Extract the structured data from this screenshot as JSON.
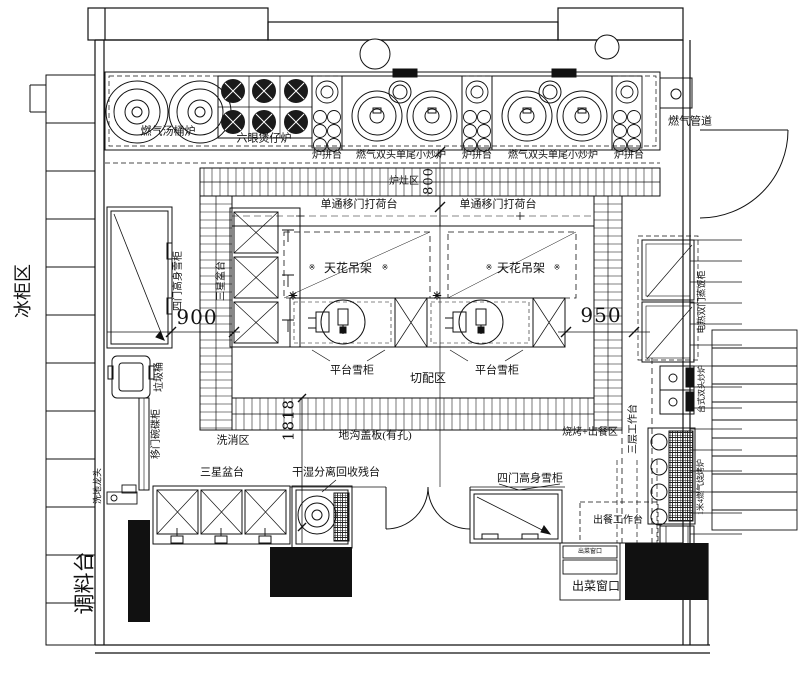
{
  "colors": {
    "ink": "#111111",
    "background": "#ffffff"
  },
  "labels": {
    "soup_stove": "燃气汤桶炉",
    "six_eye_stove": "六眼煲仔炉",
    "stove_side_table": "炉拼台",
    "wok_stove": "燃气双头单尾小炒炉",
    "gas_pipe": "燃气管道",
    "stove_zone": "炉灶区",
    "pass_counter": "单通移门打荷台",
    "ceiling_rack": "天花吊架",
    "four_door_fridge": "四门高身雪柜",
    "three_star_sink": "三星盆台",
    "platform_fridge": "平台雪柜",
    "cutting_zone": "切配区",
    "rice_steamer": "电热双门蒸饭柜",
    "trash_bin": "垃圾桶",
    "dish_cabinet": "移门碗碟柜",
    "floor_faucet": "洗地龙头",
    "washing_zone": "洗消区",
    "trench_cover": "地沟盖板(有孔)",
    "bbq_zone": "烧烤+出餐区",
    "three_layer_table": "三层工作台",
    "double_wok": "台式双头炒炉",
    "bbq_grill": "1米4燃气烧烤炉",
    "waste_table": "干湿分离回收残台",
    "serving_table": "出餐工作台",
    "pass_window": "出菜窗口",
    "freezer_zone": "冰柜区",
    "seasoning_table": "调料台"
  },
  "dimensions": {
    "cook_aisle": "800",
    "left_aisle": "900",
    "right_aisle": "950",
    "wash_aisle": "1818"
  },
  "decor": {
    "star": "✳",
    "ref_mark": "※"
  }
}
